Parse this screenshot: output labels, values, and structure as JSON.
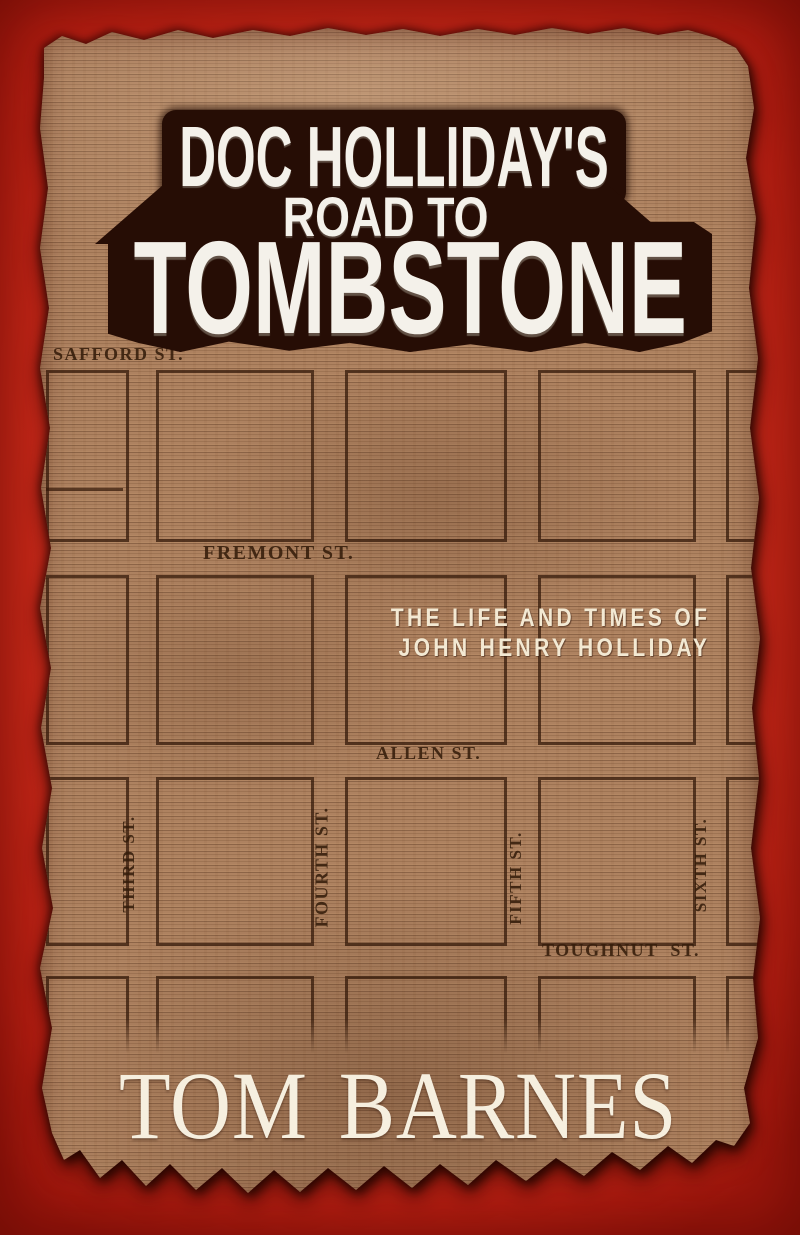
{
  "book_cover": {
    "title": {
      "line1": "DOC HOLLIDAY'S",
      "line2": "ROAD TO",
      "line3": "TOMBSTONE"
    },
    "subtitle": {
      "line1": "THE LIFE AND TIMES OF",
      "line2": "JOHN HENRY HOLLIDAY"
    },
    "author": "TOM BARNES"
  },
  "map": {
    "horizontal_streets": [
      "SAFFORD ST.",
      "FREMONT ST.",
      "ALLEN ST.",
      "TOUGHNUT  ST."
    ],
    "vertical_streets": [
      "THIRD ST.",
      "FOURTH ST.",
      "FIFTH ST.",
      "SIXTH ST."
    ]
  },
  "colors": {
    "background_red": "#d02c1b",
    "paper_tan": "#ae8260",
    "title_box_brown": "#260d05",
    "title_text_white": "#f4f1ea",
    "subtitle_cream": "#f3e9d3",
    "author_cream": "#f6efdf",
    "map_ink_brown": "#341a0a"
  }
}
